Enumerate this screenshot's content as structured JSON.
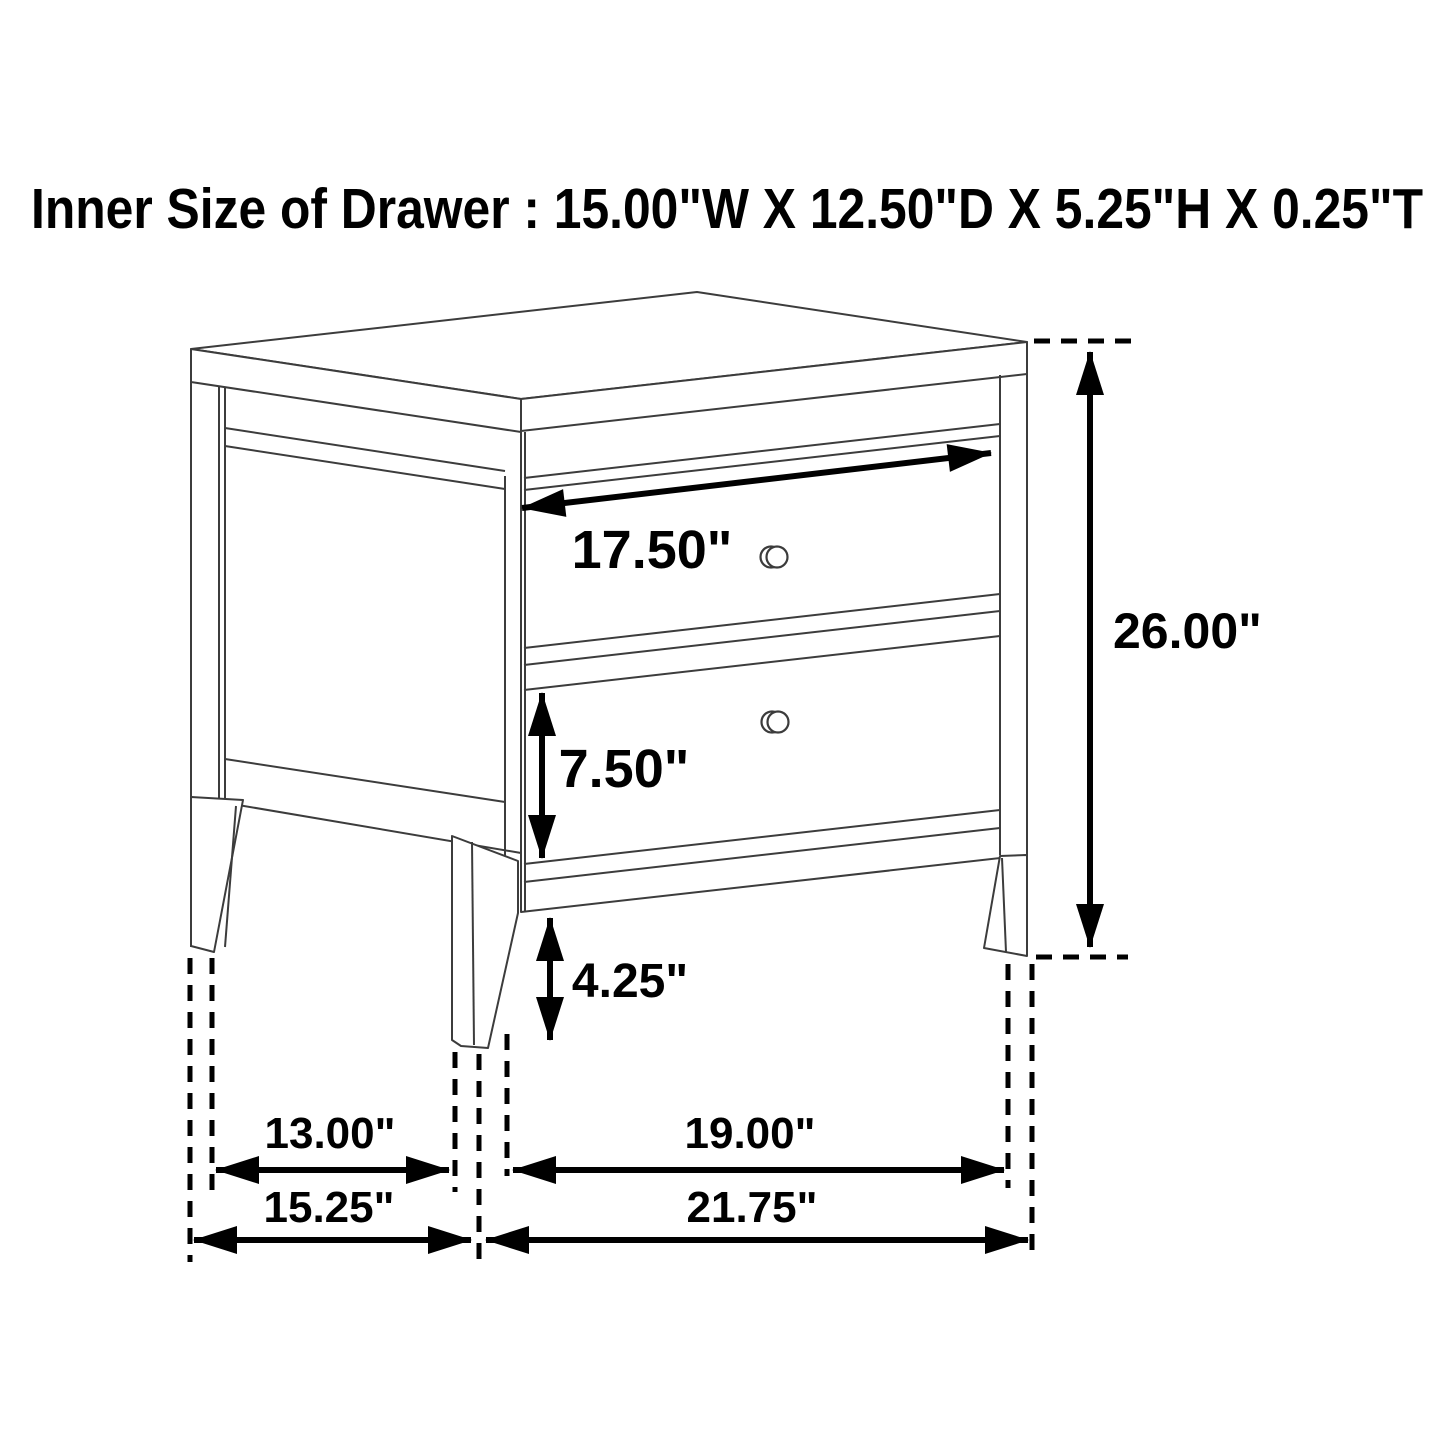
{
  "page": {
    "background": "#ffffff",
    "furniture_line_color": "#3c3c3c",
    "dimension_color": "#000000"
  },
  "title": "Inner Size of Drawer : 15.00\"W X 12.50\"D X 5.25\"H X 0.25\"T",
  "drawer_inner_size": {
    "width": "15.00\"W",
    "depth": "12.50\"D",
    "height": "5.25\"H",
    "thickness": "0.25\"T"
  },
  "furniture": {
    "description": "Two-drawer nightstand wireframe line drawing",
    "drawer_count": 2,
    "knob_count": 2
  },
  "dimensions": {
    "drawer_front_width": {
      "label": "17.50\"",
      "inches": 17.5
    },
    "lower_drawer_front_height": {
      "label": "7.50\"",
      "inches": 7.5
    },
    "leg_height": {
      "label": "4.25\"",
      "inches": 4.25
    },
    "overall_height": {
      "label": "26.00\"",
      "inches": 26.0
    },
    "side_leg_spacing": {
      "label": "13.00\"",
      "inches": 13.0
    },
    "front_leg_spacing": {
      "label": "19.00\"",
      "inches": 19.0
    },
    "overall_depth": {
      "label": "15.25\"",
      "inches": 15.25
    },
    "overall_width": {
      "label": "21.75\"",
      "inches": 21.75
    }
  }
}
